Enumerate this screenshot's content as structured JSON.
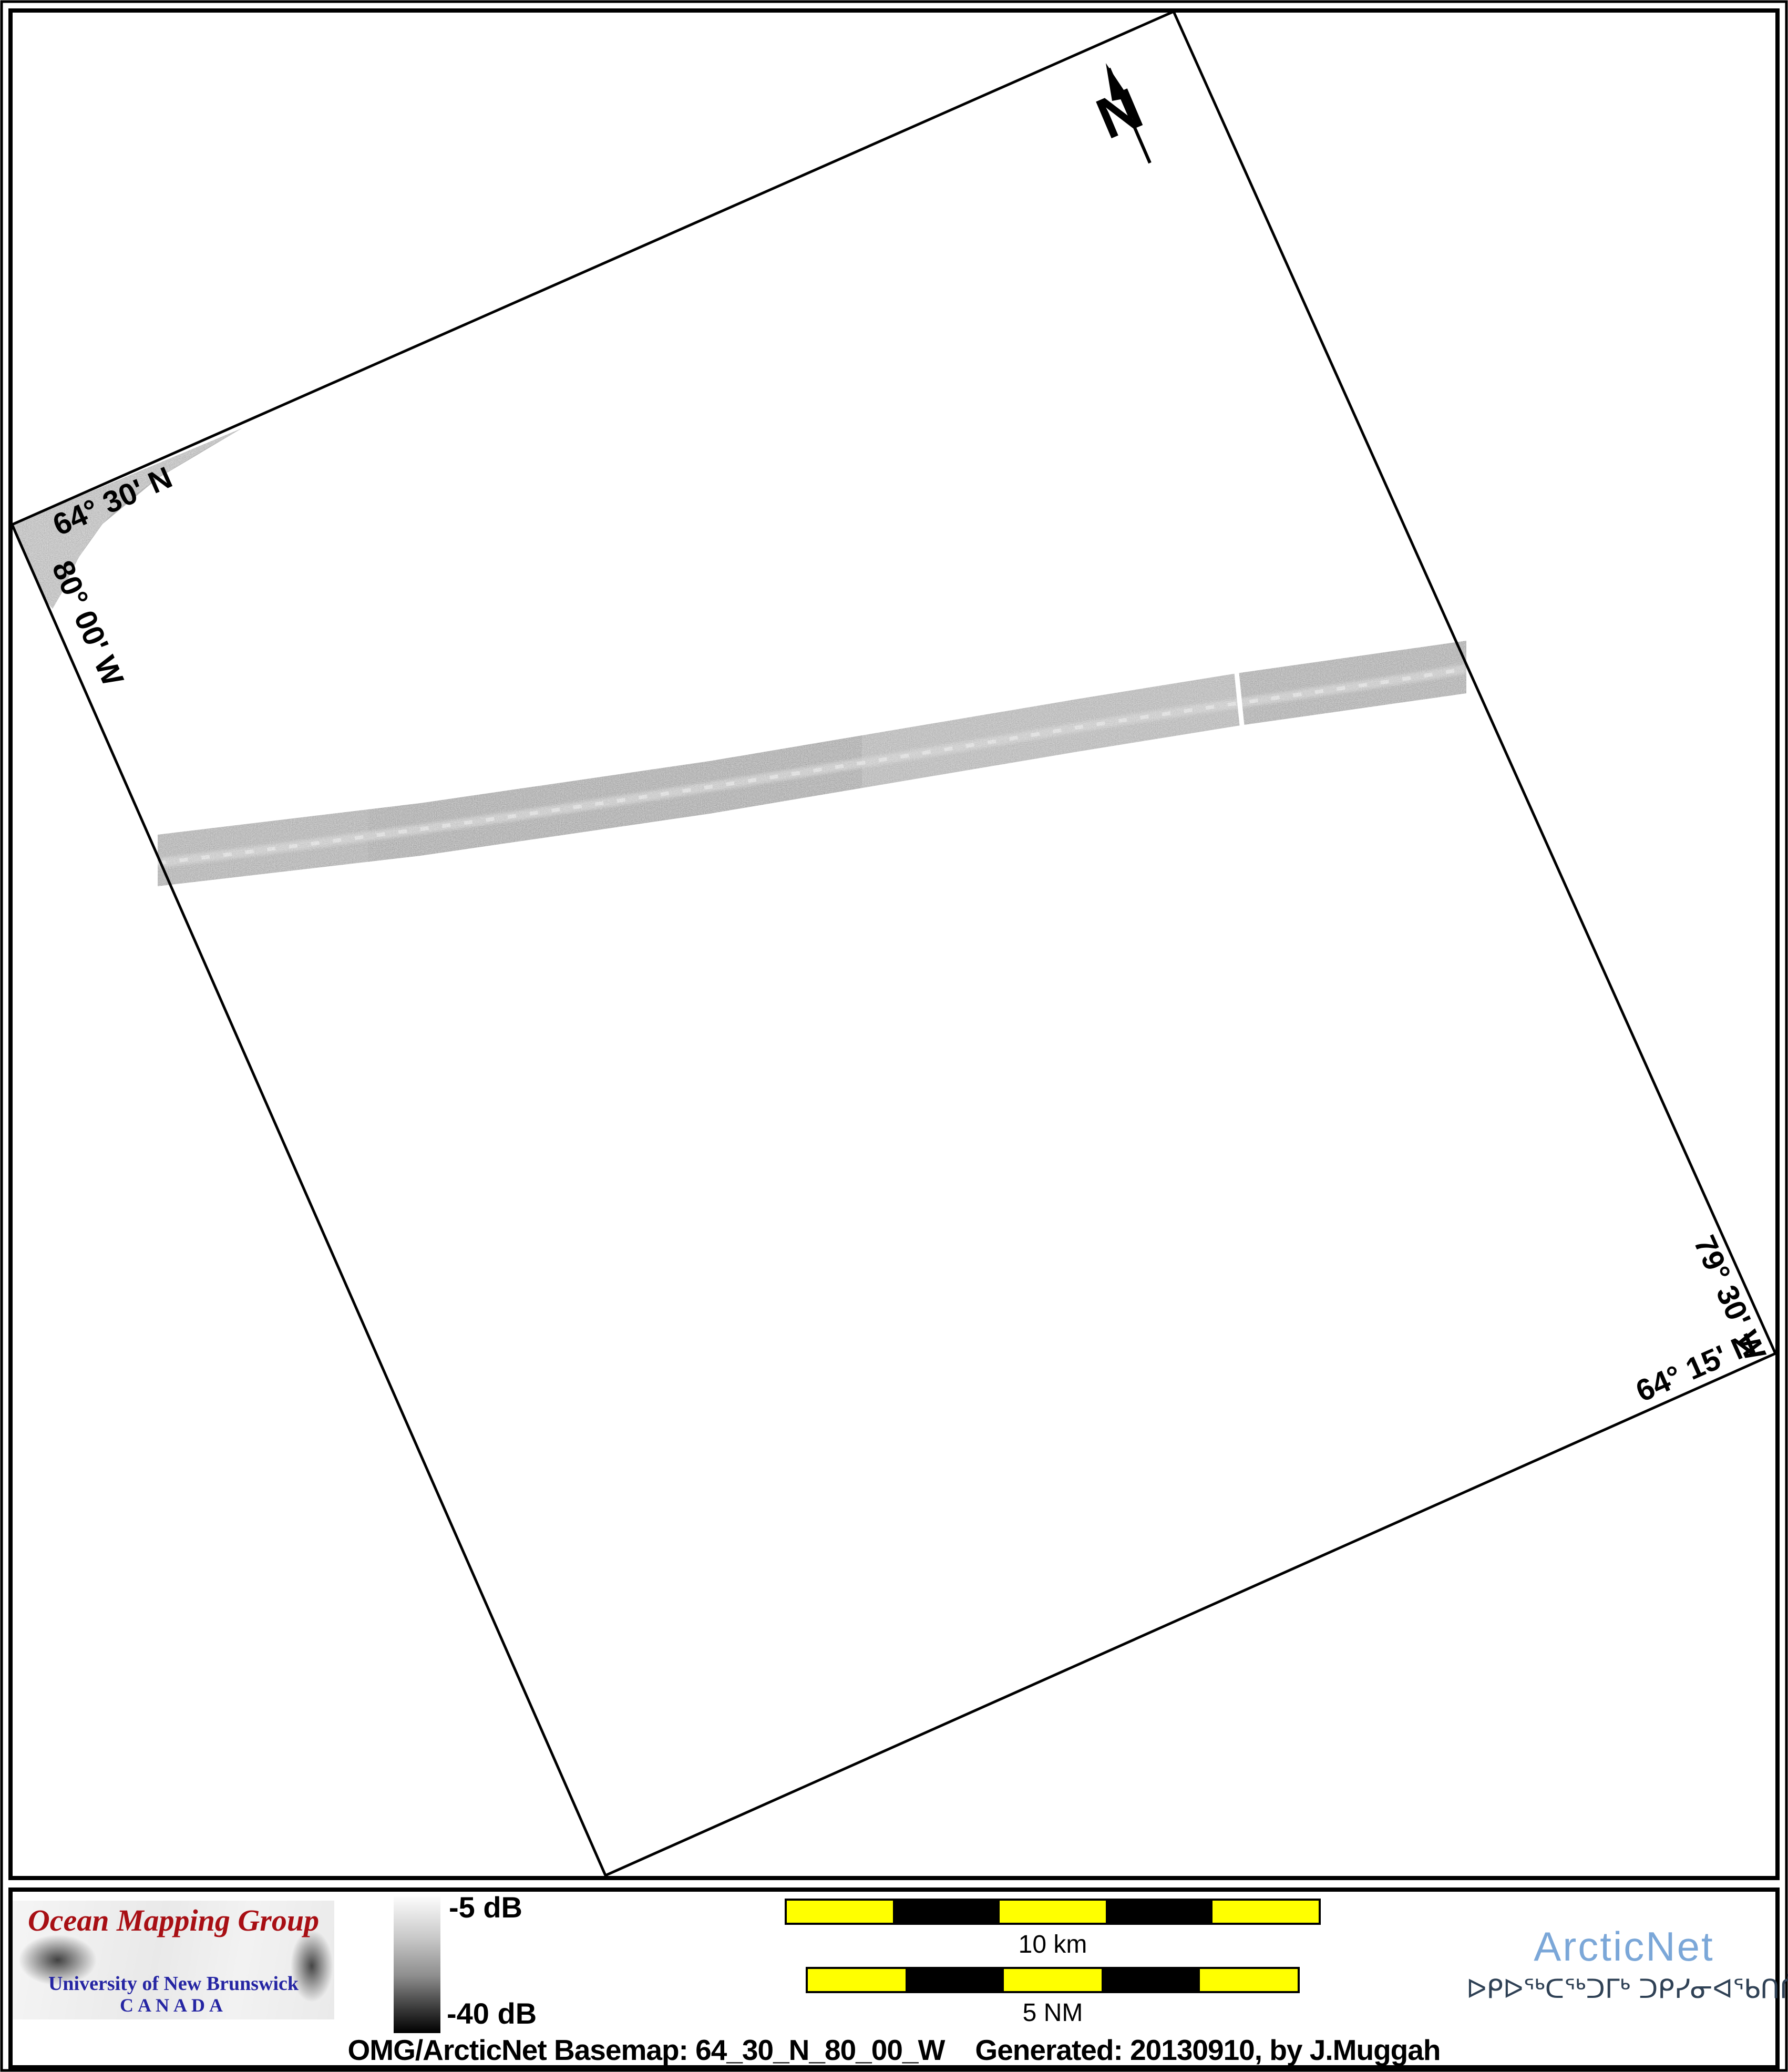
{
  "north": {
    "label": "N"
  },
  "map": {
    "corner_labels": [
      {
        "id": "lat-top-left",
        "text": "64° 30' N"
      },
      {
        "id": "lon-top-left",
        "text": "80° 00' W"
      },
      {
        "id": "lon-bottom-right",
        "text": "79° 30' W"
      },
      {
        "id": "lat-bottom-right",
        "text": "64° 15' N"
      }
    ]
  },
  "legend": {
    "top_label": "-5 dB",
    "bottom_label": "-40 dB"
  },
  "scalebars": [
    {
      "label": "10 km",
      "segments": 5
    },
    {
      "label": "5 NM",
      "segments": 5
    }
  ],
  "logos": {
    "omg": {
      "title": "Ocean Mapping Group",
      "line1": "University of New Brunswick",
      "line2": "CANADA",
      "title_color": "#a80f14",
      "text_color": "#2525a3"
    },
    "arcticnet": {
      "name": "ArcticNet",
      "syllabics": "ᐅᑭᐅᖅᑕᖅᑐᒥᒃ ᑐᑭᓯᓂᐊᖃᑎᒌᑦ",
      "name_color": "#7ba7d8",
      "syllabics_color": "#2f4155"
    }
  },
  "caption": {
    "left": "OMG/ArcticNet Basemap: 64_30_N_80_00_W",
    "right": "Generated: 20130910, by J.Muggah"
  },
  "colors": {
    "scalebar_yellow": "#ffff00",
    "scalebar_black": "#000000",
    "swath_gray": "#a6a6a6",
    "patch_gray": "#b5b5b5",
    "border_black": "#000000"
  }
}
